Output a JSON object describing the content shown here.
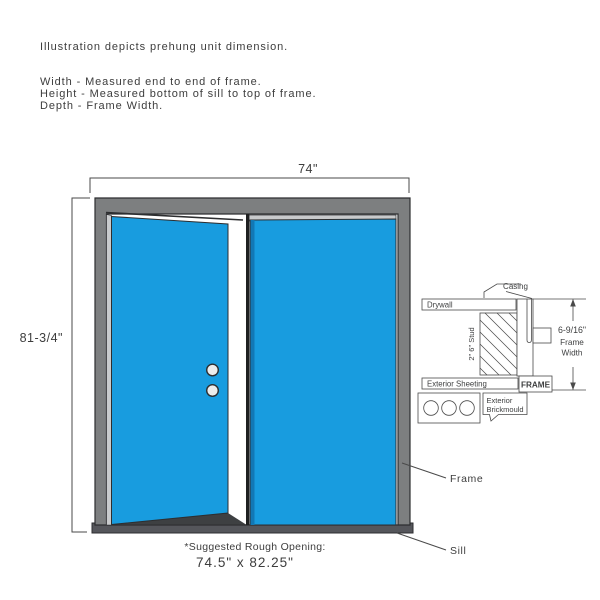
{
  "header": {
    "intro": "Illustration depicts prehung unit dimension.",
    "width_definition": "Width - Measured end to end of frame.",
    "height_definition": "Height - Measured bottom of sill to top of frame.",
    "depth_definition": "Depth - Frame Width."
  },
  "door": {
    "width_dimension": "74\"",
    "height_dimension": "81-3/4\"",
    "frame_pointer_label": "Frame",
    "sill_pointer_label": "Sill",
    "rough_opening_caption": "*Suggested Rough Opening:",
    "rough_opening_value": "74.5\" x 82.25\""
  },
  "section_detail": {
    "casing_label": "Casing",
    "drywall_label": "Drywall",
    "stud_label": "2\" 6\" Stud",
    "exterior_sheeting_label": "Exterior Sheeting",
    "frame_label": "FRAME",
    "brickmould_label_line1": "Exterior",
    "brickmould_label_line2": "Brickmould",
    "frame_width_dimension": "6-9/16\"",
    "frame_width_caption_line1": "Frame",
    "frame_width_caption_line2": "Width"
  },
  "colors": {
    "door_blue": "#189CDF",
    "door_blue_dark": "#1278B5",
    "frame_gray": "#7D7F80",
    "reveal_gray": "#C8CACC",
    "sill_dark": "#55565B",
    "outline": "#2D2E30",
    "text": "#3D3D3D"
  }
}
